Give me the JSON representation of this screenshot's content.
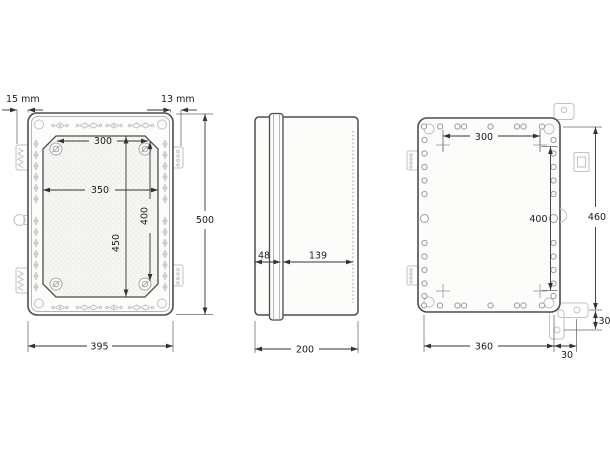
{
  "drawing_title": "enclosure-dimension-drawing",
  "front": {
    "offset_left": "15 mm",
    "offset_right": "13 mm",
    "screw_span_h": "300",
    "cover_width": "350",
    "screw_span_v": "400",
    "cover_height": "450",
    "overall_height": "500",
    "overall_width": "395"
  },
  "side": {
    "lid_depth": "48",
    "body_depth": "139",
    "overall_depth": "200"
  },
  "back": {
    "mount_span_h": "300",
    "mount_span_v": "400",
    "bracket_span_v": "460",
    "bracket_span_h": "360",
    "bracket_offset_v": "30",
    "bracket_offset_h": "30"
  }
}
